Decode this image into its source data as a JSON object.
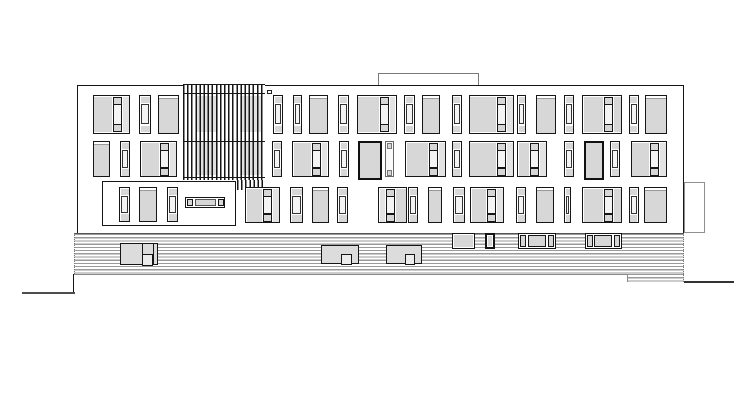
{
  "title": "building-elevation-line-drawing",
  "drawing": {
    "canvas": {
      "w": 755,
      "h": 412,
      "bg": "#ffffff"
    },
    "palette": {
      "line": "#161616",
      "pane": "#d7d7d7",
      "pane_light": "#e3e3e3",
      "mid_pane": "#f4f4f4",
      "hatch": "#9a9a9a",
      "deck_edge": "#555555",
      "roof_outline": "#7a7a7a",
      "annex_outline": "#8f8f8f",
      "ground_left": "#4d4d4d",
      "ground_right": "#333333",
      "hint": "#e0e0e0",
      "band_line": "#999999"
    },
    "facade": {
      "x": 76.5,
      "y": 85,
      "w": 607.5,
      "h": 147.5
    },
    "roof_box": {
      "x": 378,
      "y": 72.5,
      "w": 100.5,
      "h": 13
    },
    "annex_box": {
      "x": 684,
      "y": 181.5,
      "w": 20.5,
      "h": 51
    },
    "notch": {
      "x": 266.5,
      "y": 90,
      "w": 5.5,
      "h": 3.5
    },
    "louvers": {
      "x": 183,
      "y": 83.5,
      "w": 82,
      "h": 96.5,
      "slat_pitch": 4.1,
      "slat_w": 1.5,
      "ext": {
        "x": 237,
        "y": 180,
        "w": 28,
        "h": 9.5
      },
      "rails": [
        92.5,
        140.5,
        176.5
      ],
      "hints": [
        [
          196,
          96,
          22,
          36
        ],
        [
          196,
          142,
          22,
          33
        ],
        [
          240,
          96,
          21,
          36
        ],
        [
          240,
          142,
          21,
          33
        ]
      ]
    },
    "recess": {
      "x": 102,
      "y": 181,
      "w": 133.5,
      "h": 44.5
    },
    "recess_windows": {
      "y": 187,
      "h": 35,
      "items": [
        {
          "t": "narrow",
          "x": 119,
          "w": 11
        },
        {
          "t": "medium",
          "x": 138.5,
          "w": 18.5
        },
        {
          "t": "narrow",
          "x": 167,
          "w": 11
        }
      ]
    },
    "bench": {
      "x": 185,
      "y": 197,
      "w": 40,
      "h": 10.5,
      "segs": 3
    },
    "rows": [
      {
        "y": 95,
        "h": 38.5,
        "windows": [
          {
            "t": "largeR",
            "x": 92.5,
            "w": 37.5
          },
          {
            "t": "narrow",
            "x": 139,
            "w": 12
          },
          {
            "t": "medium",
            "x": 157.5,
            "w": 21
          },
          {
            "t": "narrow",
            "x": 273,
            "w": 10
          },
          {
            "t": "narrow",
            "x": 292.5,
            "w": 9.5
          },
          {
            "t": "medium",
            "x": 309,
            "w": 19
          },
          {
            "t": "narrow",
            "x": 338,
            "w": 10.5
          },
          {
            "t": "largeR",
            "x": 356.5,
            "w": 40
          },
          {
            "t": "narrow",
            "x": 404,
            "w": 10.5
          },
          {
            "t": "medium",
            "x": 421.5,
            "w": 18.5
          },
          {
            "t": "narrow",
            "x": 451.5,
            "w": 10
          },
          {
            "t": "largeR",
            "x": 468.5,
            "w": 45.5
          },
          {
            "t": "narrow",
            "x": 517,
            "w": 9
          },
          {
            "t": "medium",
            "x": 535.5,
            "w": 20
          },
          {
            "t": "narrow",
            "x": 564,
            "w": 10
          },
          {
            "t": "largeM",
            "x": 582,
            "w": 40
          },
          {
            "t": "narrow",
            "x": 628.5,
            "w": 10
          },
          {
            "t": "medium",
            "x": 645,
            "w": 21.5
          }
        ]
      },
      {
        "y": 141,
        "h": 36,
        "windows": [
          {
            "t": "medium",
            "x": 92.5,
            "w": 17.5
          },
          {
            "t": "narrow",
            "x": 120,
            "w": 10
          },
          {
            "t": "largeR",
            "x": 140,
            "w": 37
          },
          {
            "t": "narrow",
            "x": 272,
            "w": 10
          },
          {
            "t": "largeR",
            "x": 292,
            "w": 36.5
          },
          {
            "t": "narrow",
            "x": 339,
            "w": 9.5
          },
          {
            "t": "dark",
            "x": 357.5,
            "w": 24.5
          },
          {
            "t": "lightstrip",
            "x": 385,
            "w": 8.5
          },
          {
            "t": "largeR",
            "x": 405,
            "w": 41
          },
          {
            "t": "narrow",
            "x": 451.5,
            "w": 10
          },
          {
            "t": "largeR",
            "x": 468.5,
            "w": 45.5
          },
          {
            "t": "largeR",
            "x": 517,
            "w": 30
          },
          {
            "t": "narrow",
            "x": 564,
            "w": 10
          },
          {
            "t": "dark",
            "x": 583.5,
            "w": 20
          },
          {
            "t": "narrow",
            "x": 610,
            "w": 10
          },
          {
            "t": "largeR",
            "x": 630.5,
            "w": 36.5
          }
        ]
      },
      {
        "y": 187,
        "h": 36,
        "windows": [
          {
            "t": "largeR",
            "x": 245,
            "w": 35
          },
          {
            "t": "narrow",
            "x": 290,
            "w": 13
          },
          {
            "t": "medium",
            "x": 311.5,
            "w": 17
          },
          {
            "t": "narrow",
            "x": 337,
            "w": 11
          },
          {
            "t": "largeL",
            "x": 378,
            "w": 29
          },
          {
            "t": "narrow",
            "x": 408,
            "w": 10
          },
          {
            "t": "medium",
            "x": 428,
            "w": 14
          },
          {
            "t": "narrow",
            "x": 453,
            "w": 12
          },
          {
            "t": "largeR",
            "x": 470,
            "w": 34
          },
          {
            "t": "narrow",
            "x": 516,
            "w": 10
          },
          {
            "t": "medium",
            "x": 535.5,
            "w": 18.5
          },
          {
            "t": "narrow",
            "x": 564,
            "w": 7
          },
          {
            "t": "largeM",
            "x": 582,
            "w": 40
          },
          {
            "t": "narrow",
            "x": 628.5,
            "w": 10
          },
          {
            "t": "medium",
            "x": 643.5,
            "w": 23
          }
        ]
      }
    ],
    "deck": {
      "x": 74,
      "y": 232.5,
      "w": 610,
      "h": 41,
      "pitch": 3.2,
      "line_w": 1.2,
      "step": {
        "x": 627,
        "y": 273.5,
        "w": 57,
        "h": 8.5
      }
    },
    "deck_bars": [
      {
        "x": 451.5,
        "y": 232.5,
        "w": 23.5,
        "h": 16,
        "segs": 1,
        "thick": false
      },
      {
        "x": 485,
        "y": 232.5,
        "w": 10,
        "h": 16,
        "segs": 1,
        "thick": true
      },
      {
        "x": 518,
        "y": 232.5,
        "w": 37.5,
        "h": 16,
        "segs": 3,
        "thick": false
      },
      {
        "x": 584.5,
        "y": 232.5,
        "w": 37,
        "h": 16,
        "segs": 3,
        "thick": false
      }
    ],
    "planters": [
      {
        "x": 120,
        "y": 243,
        "w": 38,
        "h": 21.5,
        "div1": 20.5,
        "div2": 32,
        "sq": {
          "dx": 20.5,
          "dy": 10,
          "w": 11.5,
          "h": 11.5
        }
      },
      {
        "x": 320.5,
        "y": 245,
        "w": 38,
        "h": 18.5,
        "sq": {
          "dx": 19.5,
          "dy": 7.5,
          "w": 11,
          "h": 11
        }
      },
      {
        "x": 385.5,
        "y": 245,
        "w": 36,
        "h": 18.5,
        "sq": {
          "dx": 18,
          "dy": 8,
          "w": 10.5,
          "h": 10.5
        }
      }
    ],
    "ground": {
      "left": {
        "x1": 22,
        "x2": 74.5,
        "y": 292,
        "drop_y1": 273.5
      },
      "right": {
        "x1": 684,
        "x2": 734,
        "y": 280.5
      }
    }
  }
}
